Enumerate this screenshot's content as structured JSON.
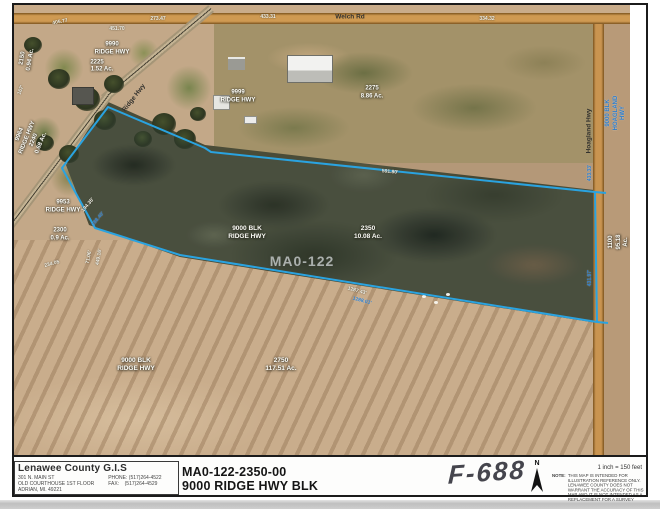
{
  "map": {
    "watermark": "MA0-122",
    "boundary_color": "#2aa3e0",
    "road_labels": [
      {
        "text": "Welch Rd"
      },
      {
        "text": "Ridge Hwy"
      },
      {
        "text": "Hoagland Hwy"
      }
    ],
    "parcel_labels": [
      {
        "text": "9990\nRIDGE HWY"
      },
      {
        "text": "2225"
      },
      {
        "text": "1.52 Ac."
      },
      {
        "text": "2150\n0.94 Ac."
      },
      {
        "text": "9964\nRIDGE HWY\n2240\n0.68 Ac."
      },
      {
        "text": "9999\nRIDGE HWY"
      },
      {
        "text": "2275\n8.86 Ac."
      },
      {
        "text": "9953\nRIDGE HWY"
      },
      {
        "text": "2300\n0.9 Ac."
      },
      {
        "text": "9000 BLK\nRIDGE HWY"
      },
      {
        "text": "2350\n10.08 Ac."
      },
      {
        "text": "9000 BLK\nRIDGE HWY"
      },
      {
        "text": "2750\n117.51 Ac."
      },
      {
        "text": "1100\n95.18 Ac."
      },
      {
        "text": "9000 BLK\nHOAGLAND HWY"
      }
    ],
    "dimension_labels": [
      {
        "text": "273.47"
      },
      {
        "text": "433.31"
      },
      {
        "text": "334.32"
      },
      {
        "text": "405.77"
      },
      {
        "text": "451.70"
      },
      {
        "text": "591.80'"
      },
      {
        "text": "1287.43'"
      },
      {
        "text": "1288.01'"
      },
      {
        "text": "194.35'"
      },
      {
        "text": "188.40'"
      },
      {
        "text": "71.06'"
      },
      {
        "text": "449.16'"
      },
      {
        "text": "234.05"
      },
      {
        "text": "167'"
      },
      {
        "text": "433.33'"
      },
      {
        "text": "431.97'"
      }
    ]
  },
  "footer": {
    "org": "Lenawee County G.I.S",
    "address1": "301 N. MAIN ST",
    "address2": "OLD COURTHOUSE 1ST FLOOR",
    "address3": "ADRIAN, MI. 49221",
    "phone_label": "PHONE:",
    "phone": "(517)264-4522",
    "fax_label": "FAX:",
    "fax": "(517)264-4529",
    "parcel_id": "MA0-122-2350-00",
    "parcel_address": "9000 RIDGE HWY BLK",
    "handwritten": "F-688",
    "north_label": "N",
    "scale": "1 inch = 150 feet",
    "note_label": "NOTE:",
    "note": "THIS MAP IS INTENDED FOR ILLUSTRATION REFERENCE ONLY.  LENAWEE COUNTY DOES NOT WARRANT THE ACCURACY OF THIS MAP AND IT IS NOT INTENDED AS A REPLACEMENT FOR A SURVEY"
  }
}
